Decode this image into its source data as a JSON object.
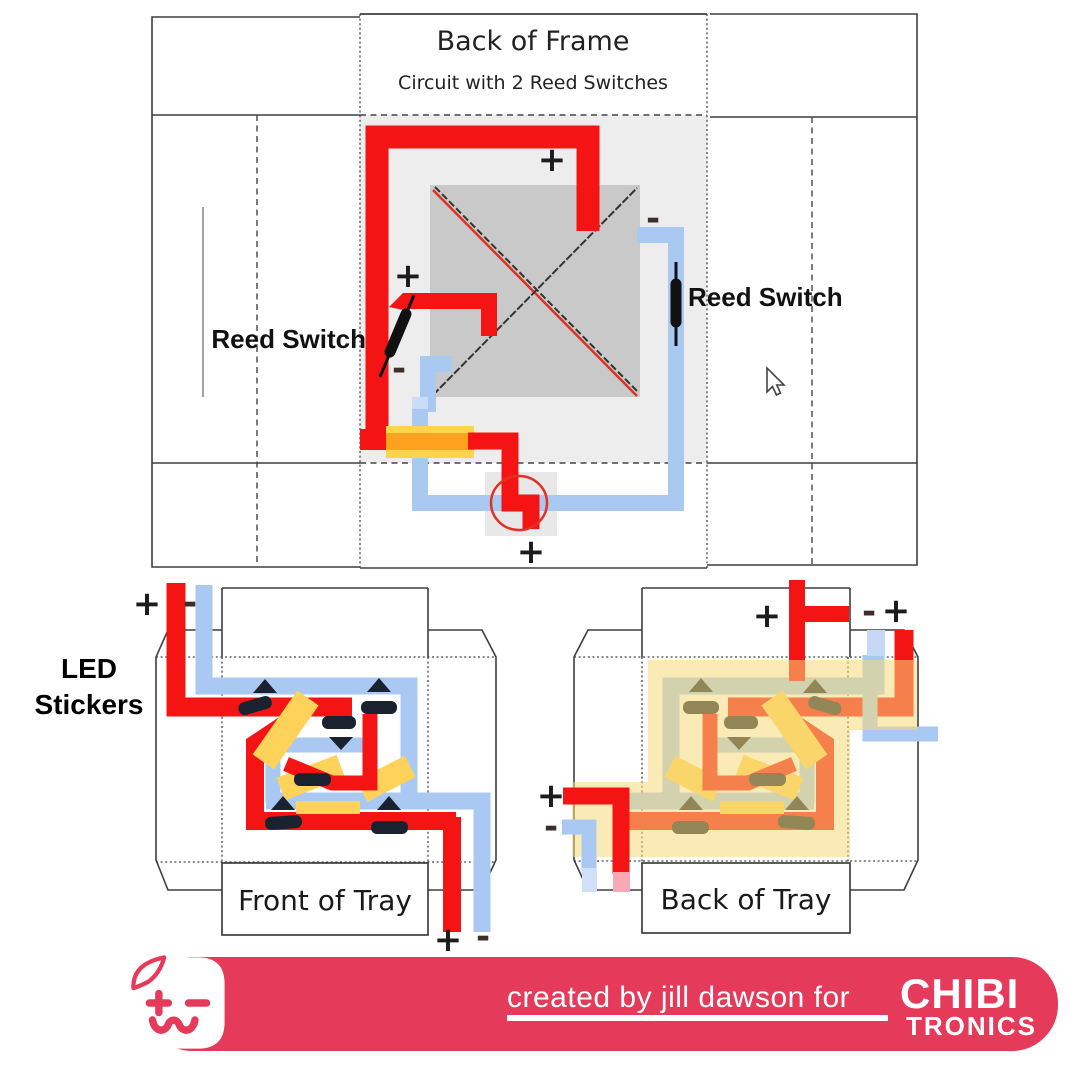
{
  "frame": {
    "title": "Back of Frame",
    "subtitle": "Circuit with 2 Reed Switches",
    "reed_switch_left": "Reed Switch",
    "reed_switch_right": "Reed Switch"
  },
  "front_tray": {
    "label": "Front of Tray",
    "led_stickers_line1": "LED",
    "led_stickers_line2": "Stickers"
  },
  "back_tray": {
    "label": "Back of Tray"
  },
  "symbols": {
    "plus": "+",
    "minus": "-"
  },
  "footer": {
    "credit": "created by jill dawson for",
    "brand_top": "CHIBI",
    "brand_bottom": "TRONICS"
  },
  "icons": {
    "cursor": "arrow-pointer",
    "logo": "chibitronics-sticker-face",
    "reed_switch": "black-capsule-on-trace",
    "led_sticker": "black-triangle-and-bar"
  },
  "colors": {
    "trace_positive_red": "#f51414",
    "trace_negative_blue": "#a9c9f2",
    "battery_core_orange": "#ffa21f",
    "battery_yellow": "#ffd44d",
    "overlay_yellow": "#f6d878",
    "panel_gray": "#ededed",
    "square_gray": "#c9c9c9",
    "led_sticker_black": "#1a2230",
    "banner_pink": "#e63a5a",
    "annotation_circle_red": "#e23023"
  }
}
